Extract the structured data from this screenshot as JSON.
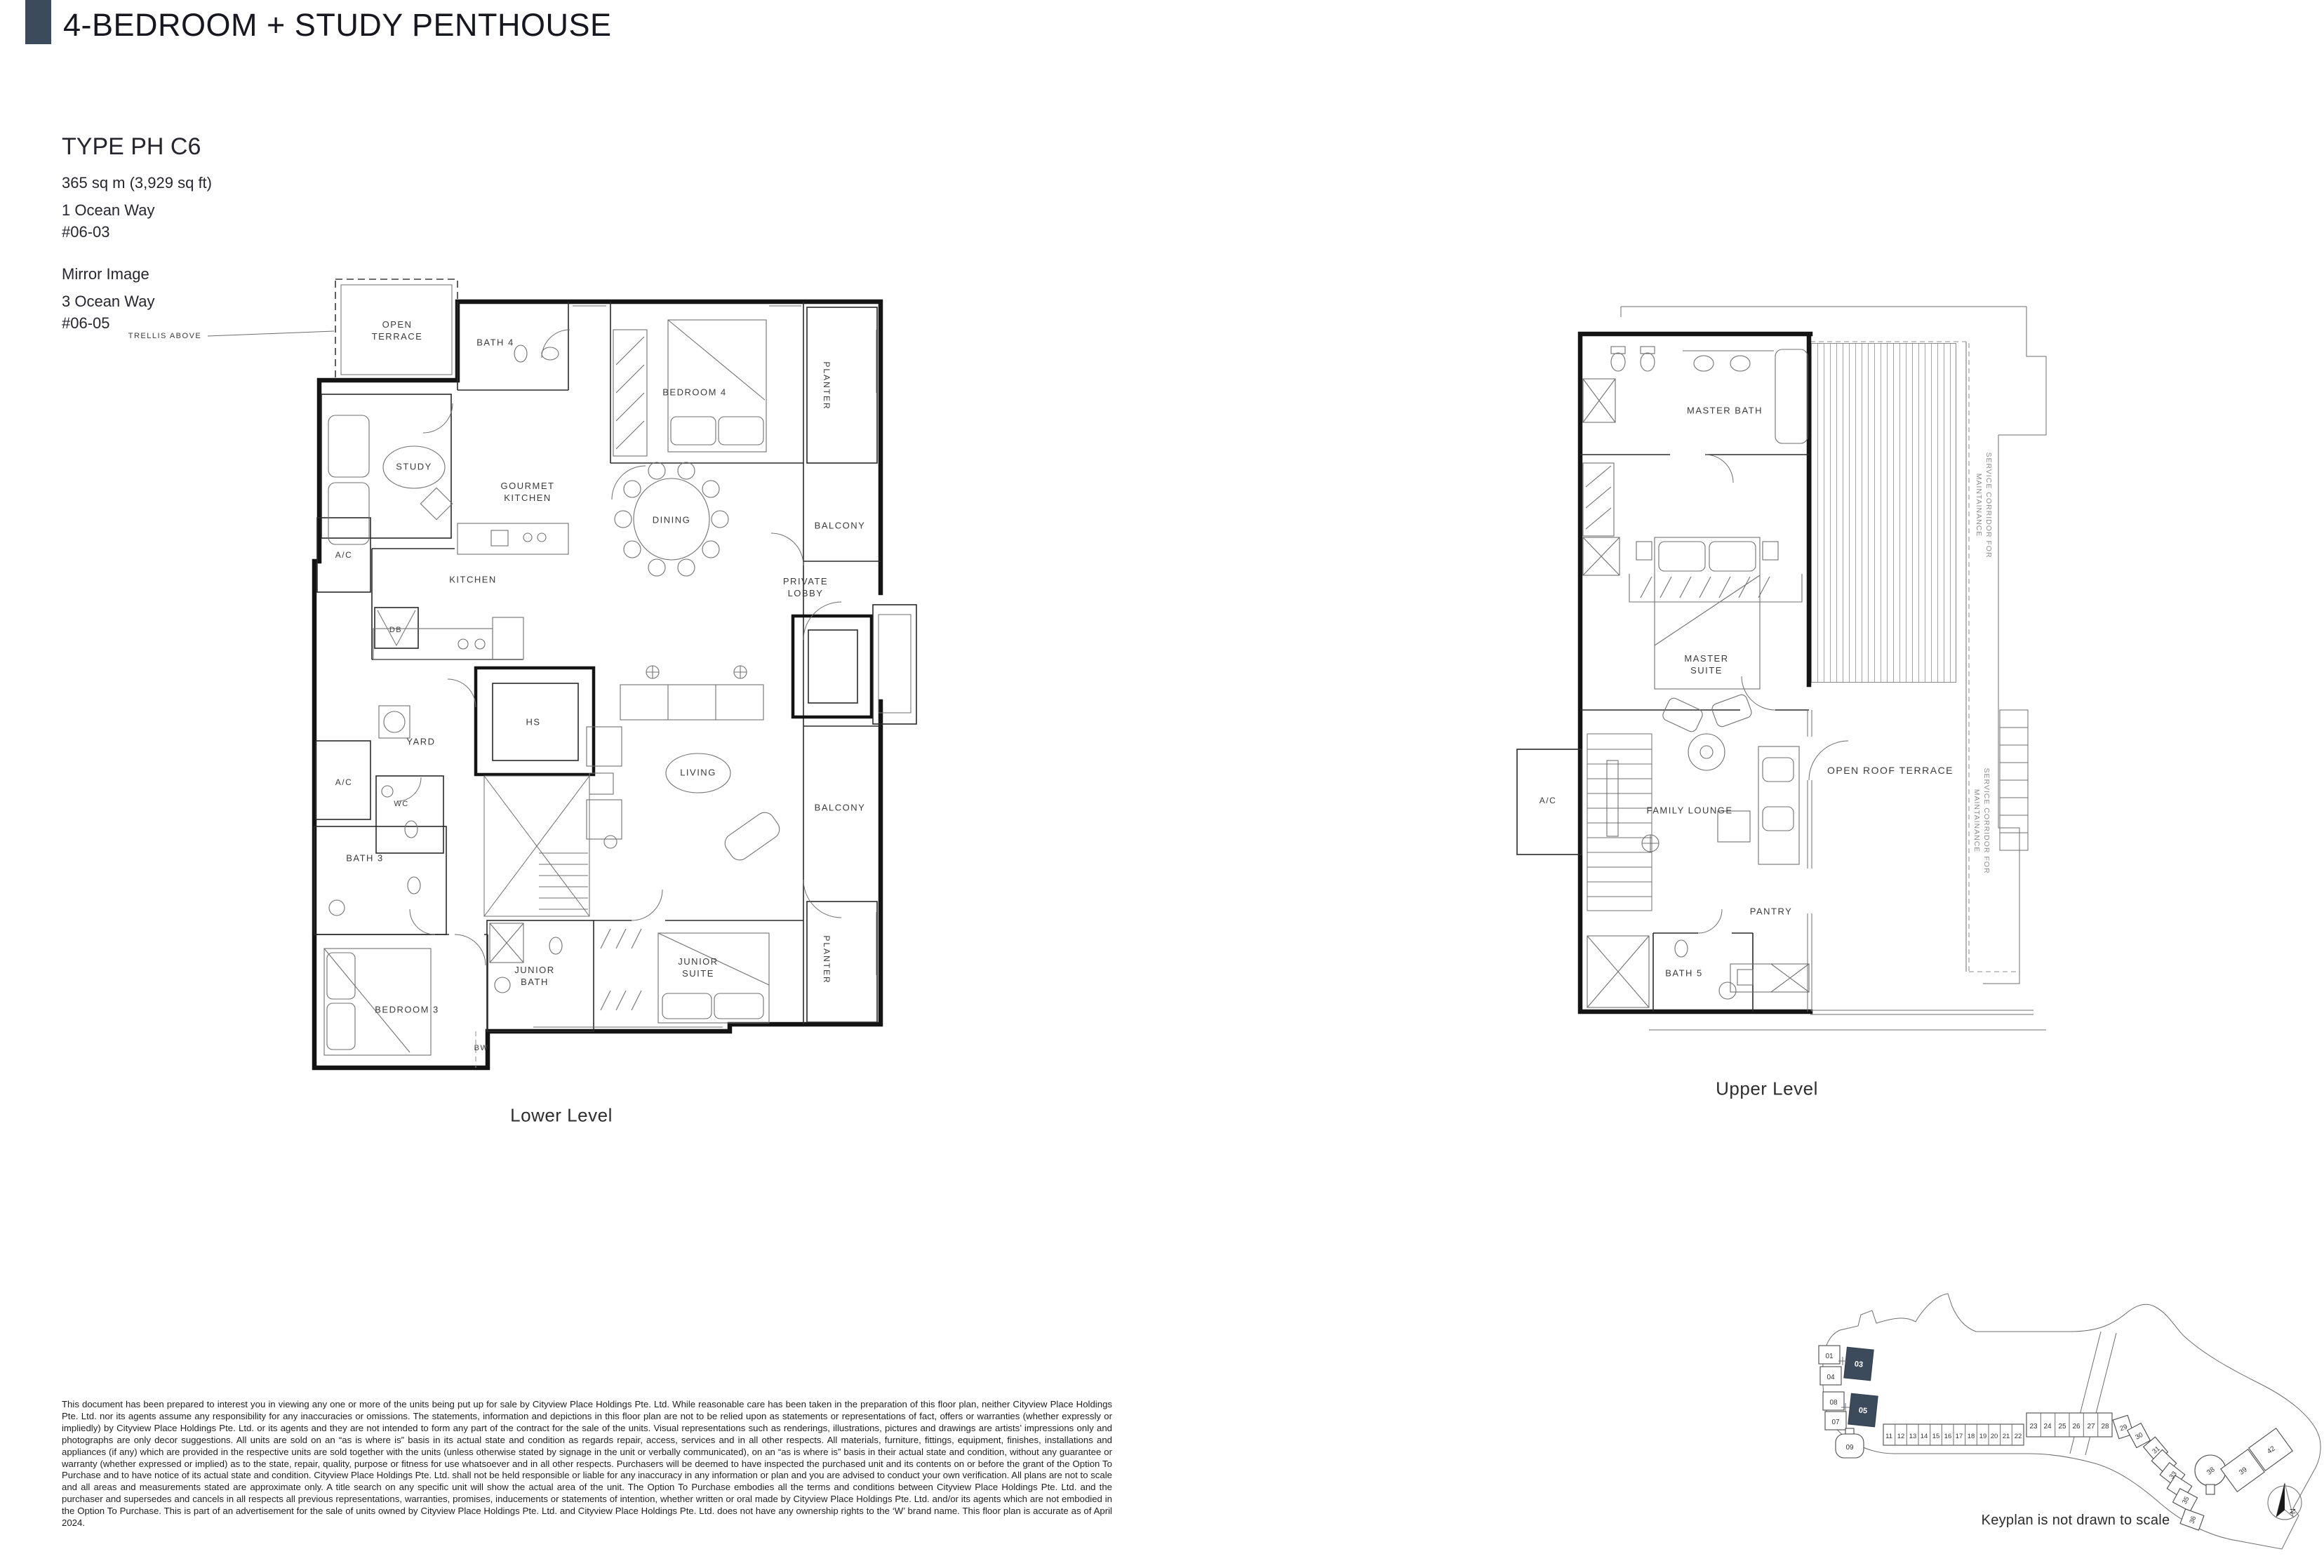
{
  "header": {
    "title": "4-BEDROOM + STUDY PENTHOUSE",
    "accent_color": "#3c4b5c"
  },
  "unit_info": {
    "type_label": "TYPE PH C6",
    "area": "365 sq m (3,929 sq ft)",
    "address_1": "1 Ocean Way",
    "unit_1": "#06-03",
    "mirror_label": "Mirror Image",
    "address_2": "3 Ocean Way",
    "unit_2": "#06-05"
  },
  "plans": {
    "lower": {
      "caption": "Lower Level",
      "annotation_trellis": "TRELLIS ABOVE",
      "rooms": {
        "open_terrace": "OPEN TERRACE",
        "bath_4": "BATH 4",
        "bedroom_4": "BEDROOM 4",
        "planter_top": "PLANTER",
        "study": "STUDY",
        "gourmet_kitchen": "GOURMET KITCHEN",
        "dining": "DINING",
        "balcony_top": "BALCONY",
        "ac_top": "A/C",
        "kitchen": "KITCHEN",
        "private_lobby": "PRIVATE LOBBY",
        "db": "DB",
        "hs": "HS",
        "yard": "YARD",
        "ac_bottom": "A/C",
        "wc": "WC",
        "bath_3": "BATH 3",
        "living": "LIVING",
        "balcony_bottom": "BALCONY",
        "junior_bath": "JUNIOR BATH",
        "junior_suite": "JUNIOR SUITE",
        "bw": "BW",
        "bedroom_3": "BEDROOM 3",
        "planter_bottom": "PLANTER"
      }
    },
    "upper": {
      "caption": "Upper Level",
      "rooms": {
        "master_bath": "MASTER BATH",
        "master_suite": "MASTER SUITE",
        "ac": "A/C",
        "family_lounge": "FAMILY LOUNGE",
        "open_roof_terrace": "OPEN ROOF TERRACE",
        "pantry": "PANTRY",
        "bath_5": "BATH 5",
        "service_corridor_1": "SERVICE CORRIDOR FOR MAINTAINANCE",
        "service_corridor_2": "SERVICE CORRIDOR FOR MAINTAINANCE"
      }
    }
  },
  "keyplan": {
    "caption": "Keyplan is not drawn to scale",
    "north_label": "N",
    "highlight_color": "#3c4b5c",
    "highlighted_units": "03, 05",
    "blocks": {
      "b01": "01",
      "b03": "03",
      "b04": "04",
      "b05": "05",
      "b07": "07",
      "b08": "08",
      "b09": "09",
      "b11": "11",
      "b12": "12",
      "b13": "13",
      "b14": "14",
      "b15": "15",
      "b16": "16",
      "b17": "17",
      "b18": "18",
      "b19": "19",
      "b20": "20",
      "b21": "21",
      "b22": "22",
      "b23": "23",
      "b24": "24",
      "b25": "25",
      "b26": "26",
      "b27": "27",
      "b28": "28",
      "b29": "29",
      "b30": "30",
      "b31": "31",
      "b33": "33",
      "b35": "35",
      "b36": "36",
      "b38": "38",
      "b39": "39",
      "b42": "42"
    }
  },
  "disclaimer": "This document has been prepared to interest you in viewing any one or more of the units being put up for sale by Cityview Place Holdings Pte. Ltd. While reasonable care has been taken in the preparation of this floor plan, neither Cityview Place Holdings Pte. Ltd. nor its agents assume any responsibility for any inaccuracies or omissions. The statements, information and depictions in this floor plan are not to be relied upon as statements or representations of fact, offers or warranties (whether expressly or impliedly) by Cityview Place Holdings Pte. Ltd. or its agents and they are not intended to form any part of the contract for the sale of the units. Visual representations such as renderings, illustrations, pictures and drawings are artists’ impressions only and photographs are only decor suggestions. All units are sold on an “as is where is” basis in its actual state and condition as regards repair, access, services and in all other respects. All materials, furniture, fittings, equipment, finishes, installations and appliances (if any) which are provided in the respective units are sold together with the units (unless otherwise stated by signage in the unit or verbally communicated), on an “as is where is” basis in their actual state and condition, without any guarantee or warranty (whether expressed or implied) as to the state, repair, quality, purpose or fitness for use whatsoever and in all other respects. Purchasers will be deemed to have inspected the purchased unit and its contents on or before the grant of the Option To Purchase and to have notice of its actual state and condition. Cityview Place Holdings Pte. Ltd. shall not be held responsible or liable for any inaccuracy in any information or plan and you are advised to conduct your own verification. All plans are not to scale and all areas and measurements stated are approximate only. A title search on any specific unit will show the actual area of the unit. The Option To Purchase embodies all the terms and conditions between Cityview Place Holdings Pte. Ltd. and the purchaser and supersedes and cancels in all respects all previous representations, warranties, promises, inducements or statements of intention, whether written or oral made by Cityview Place Holdings Pte. Ltd. and/or its agents which are not embodied in the Option To Purchase. This is part of an advertisement for the sale of units owned by Cityview Place Holdings Pte. Ltd. and Cityview Place Holdings Pte. Ltd. does not have any ownership rights to the ‘W’ brand name. This floor plan is accurate as of April 2024."
}
